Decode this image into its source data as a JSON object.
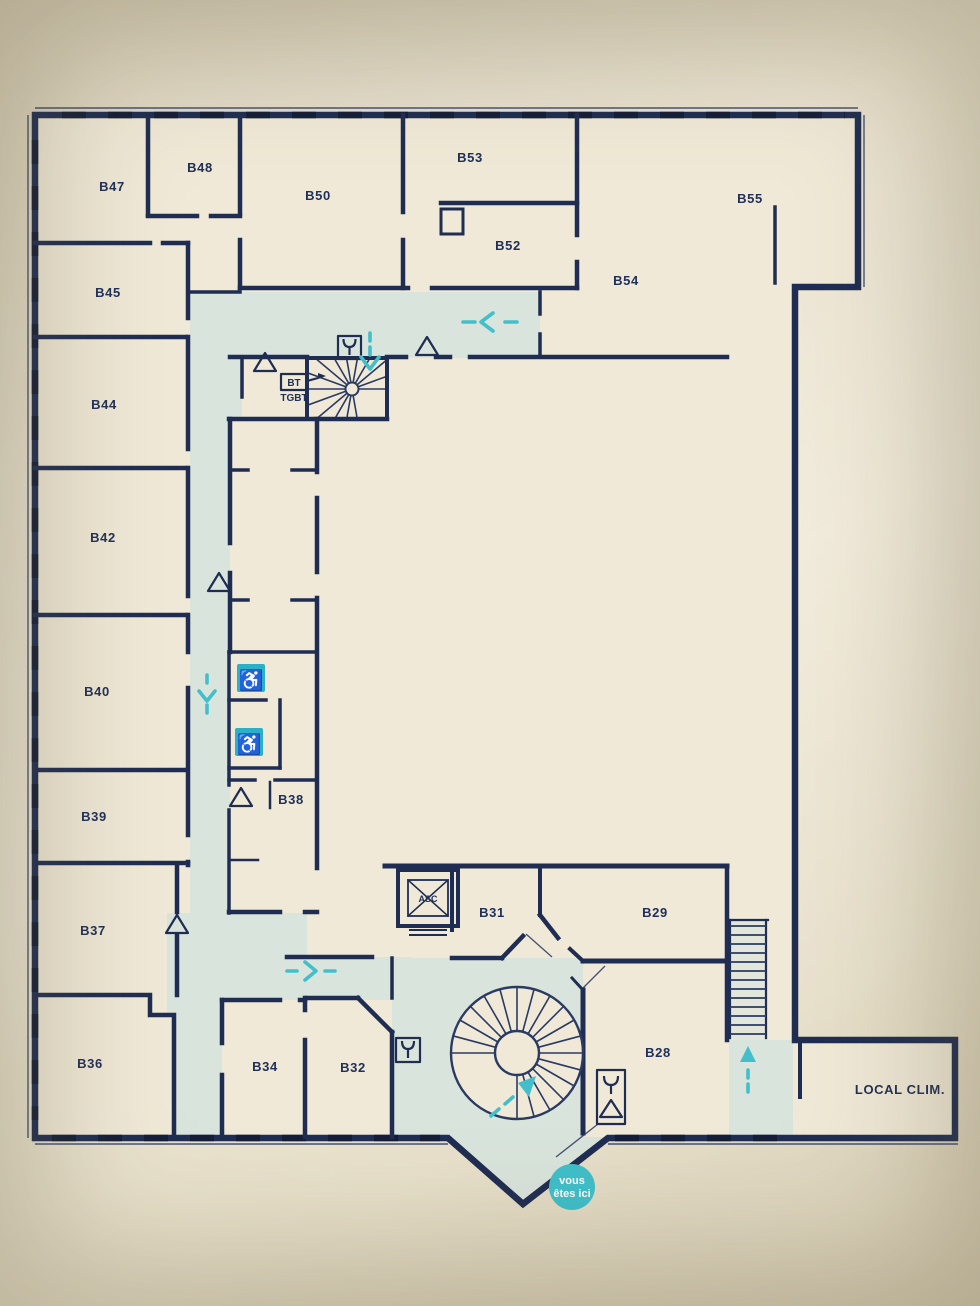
{
  "rooms": [
    {
      "id": "b47",
      "label": "B47"
    },
    {
      "id": "b48",
      "label": "B48"
    },
    {
      "id": "b50",
      "label": "B50"
    },
    {
      "id": "b53",
      "label": "B53"
    },
    {
      "id": "b52",
      "label": "B52"
    },
    {
      "id": "b54",
      "label": "B54"
    },
    {
      "id": "b55",
      "label": "B55"
    },
    {
      "id": "b45",
      "label": "B45"
    },
    {
      "id": "b44",
      "label": "B44"
    },
    {
      "id": "b42",
      "label": "B42"
    },
    {
      "id": "b40",
      "label": "B40"
    },
    {
      "id": "b39",
      "label": "B39"
    },
    {
      "id": "b38",
      "label": "B38"
    },
    {
      "id": "b37",
      "label": "B37"
    },
    {
      "id": "b36",
      "label": "B36"
    },
    {
      "id": "b34",
      "label": "B34"
    },
    {
      "id": "b32",
      "label": "B32"
    },
    {
      "id": "b31",
      "label": "B31"
    },
    {
      "id": "b29",
      "label": "B29"
    },
    {
      "id": "b28",
      "label": "B28"
    }
  ],
  "facilities": {
    "elevator": "ASC",
    "electrical_line1": "BT",
    "electrical_line2": "TGBT",
    "hvac_room": "LOCAL CLIM."
  },
  "you_are_here": {
    "line1": "vous",
    "line2": "êtes ici"
  },
  "icon_names": [
    "wheelchair-accessible-icon",
    "fire-hose-icon",
    "alarm-call-point-icon",
    "spiral-staircase",
    "fan-staircase",
    "straight-staircase",
    "elevator-icon",
    "you-are-here-marker",
    "direction-arrow"
  ],
  "colors": {
    "wall": "#1f2d52",
    "corridor": "#d9e4dc",
    "accent_teal": "#43bfcb",
    "accessible_blue": "#2cb0c6",
    "background": "#e9e1cd",
    "plan_paper": "#f0e9d7"
  }
}
